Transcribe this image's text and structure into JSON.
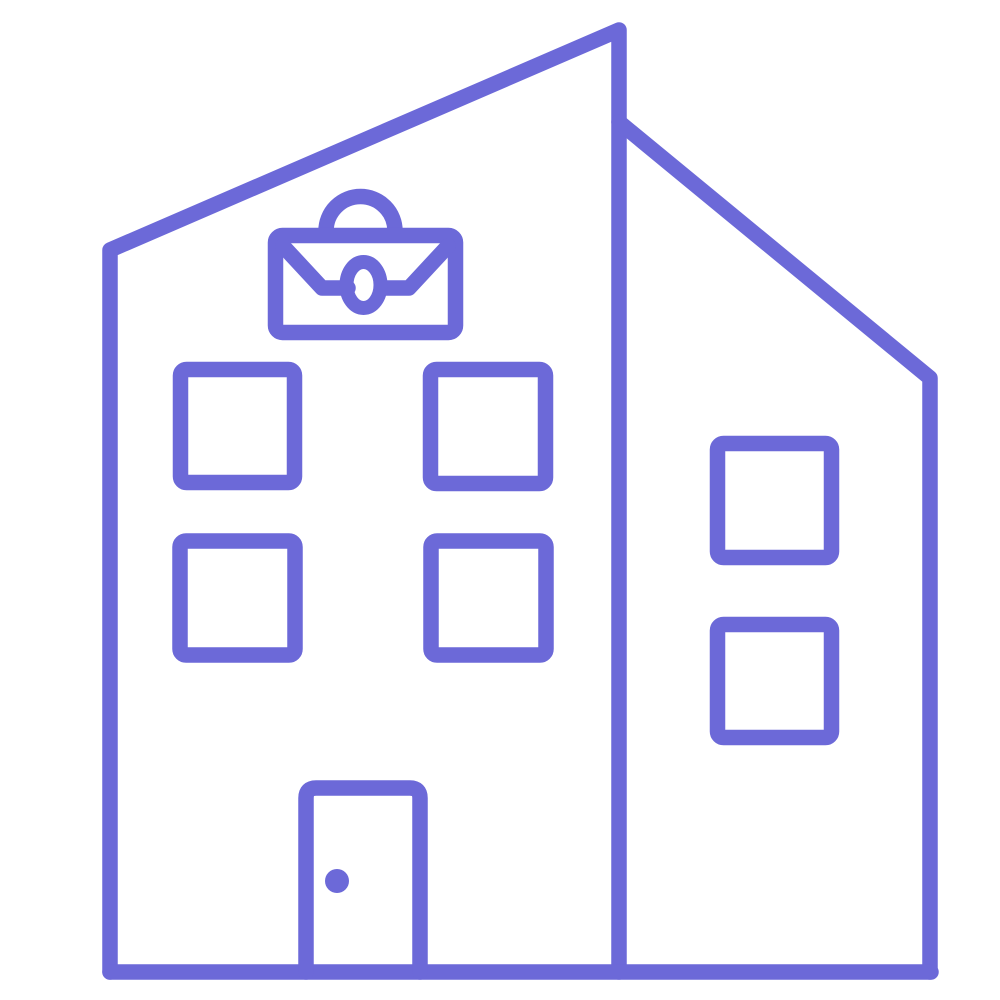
{
  "page": {
    "background_color": "#FFFFFF"
  },
  "icon": {
    "name": "office-building-with-briefcase-icon",
    "description": "line-art office building icon with slanted roof, briefcase emblem, six windows and a door",
    "stroke_color": "#6C69D8",
    "background_color": "#FFFFFF"
  }
}
